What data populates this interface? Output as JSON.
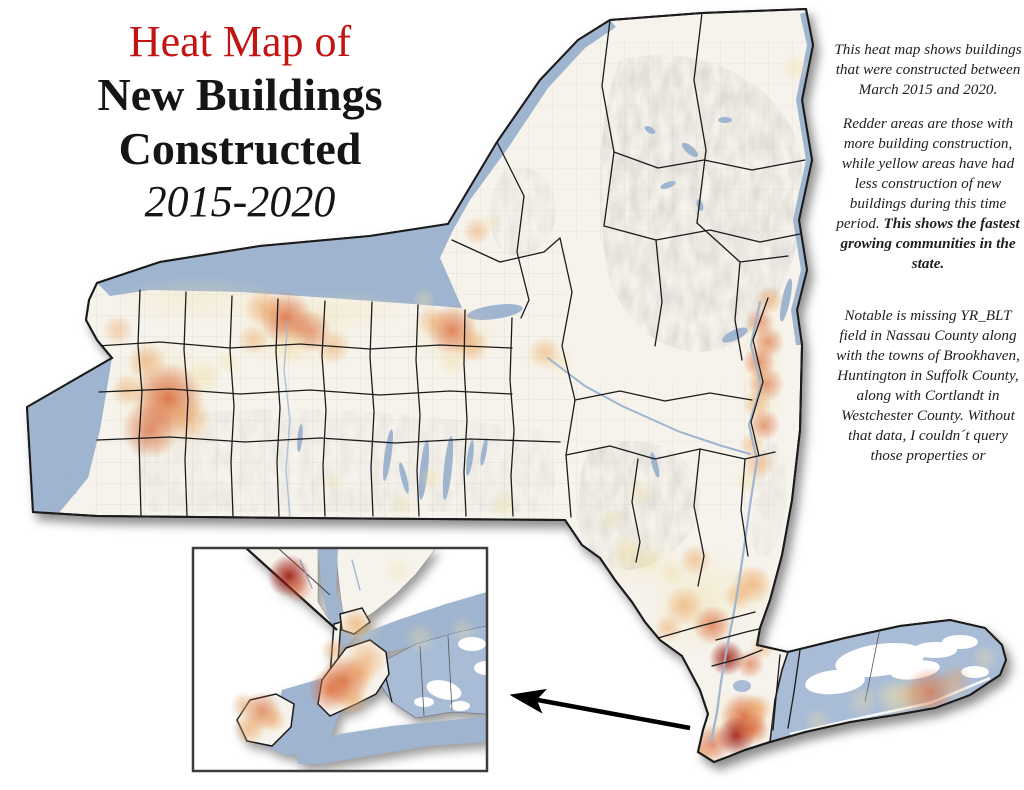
{
  "title": {
    "line1": "Heat Map of",
    "line2": "New Buildings",
    "line3": "Constructed",
    "line4": "2015-2020"
  },
  "description": {
    "para1": "This heat map shows buildings that were constructed between March 2015 and 2020.",
    "para2": "Redder areas are those with more building construction, while yellow areas have had less construction of new buildings during this time period. ",
    "para2_bold": "This shows the fastest growing communities in the state.",
    "para3": "Notable is missing YR_BLT field in Nassau County along with the towns of Brookhaven, Huntington in Suffolk County, along with Cortlandt in Westchester County. Without that data, I couldn´t query those properties or"
  },
  "map": {
    "colors": {
      "title_accent": "#c31414",
      "body_text": "#1f1f1f",
      "water": "#9fb4cf",
      "missing_data": "#a9bcd6",
      "land": "#f6f3ec",
      "county_line": "#1b1b1b",
      "town_line": "#b6b1a3",
      "arrow": "#000000"
    },
    "heat": {
      "palette": {
        "yellow": "#f0dfa6",
        "orange": "#ec9f58",
        "red": "#d95f2e",
        "dark": "#9c150a"
      },
      "main_spots": [
        [
          168,
          398,
          20,
          "red",
          0.85
        ],
        [
          150,
          430,
          16,
          "red",
          0.7
        ],
        [
          147,
          362,
          11,
          "orange",
          0.6
        ],
        [
          188,
          420,
          13,
          "orange",
          0.55
        ],
        [
          127,
          390,
          9,
          "orange",
          0.5
        ],
        [
          118,
          330,
          9,
          "orange",
          0.45
        ],
        [
          205,
          375,
          10,
          "yellow",
          0.5
        ],
        [
          286,
          318,
          15,
          "red",
          0.8
        ],
        [
          264,
          308,
          11,
          "orange",
          0.6
        ],
        [
          310,
          331,
          12,
          "red",
          0.6
        ],
        [
          333,
          347,
          10,
          "orange",
          0.5
        ],
        [
          253,
          340,
          9,
          "orange",
          0.45
        ],
        [
          290,
          346,
          10,
          "yellow",
          0.5
        ],
        [
          228,
          362,
          7,
          "yellow",
          0.45
        ],
        [
          452,
          330,
          14,
          "red",
          0.75
        ],
        [
          471,
          345,
          10,
          "orange",
          0.6
        ],
        [
          432,
          321,
          9,
          "orange",
          0.5
        ],
        [
          452,
          361,
          9,
          "yellow",
          0.5
        ],
        [
          424,
          300,
          7,
          "yellow",
          0.4
        ],
        [
          477,
          231,
          8,
          "orange",
          0.5
        ],
        [
          492,
          222,
          6,
          "yellow",
          0.4
        ],
        [
          545,
          352,
          9,
          "orange",
          0.45
        ],
        [
          561,
          363,
          8,
          "yellow",
          0.4
        ],
        [
          795,
          68,
          8,
          "yellow",
          0.45
        ],
        [
          770,
          300,
          8,
          "orange",
          0.6
        ],
        [
          760,
          322,
          8,
          "red",
          0.55
        ],
        [
          768,
          342,
          9,
          "red",
          0.6
        ],
        [
          759,
          362,
          9,
          "red",
          0.65
        ],
        [
          766,
          384,
          10,
          "red",
          0.6
        ],
        [
          757,
          404,
          8,
          "orange",
          0.55
        ],
        [
          764,
          425,
          9,
          "red",
          0.6
        ],
        [
          752,
          445,
          7,
          "orange",
          0.5
        ],
        [
          758,
          464,
          9,
          "orange",
          0.55
        ],
        [
          748,
          481,
          8,
          "yellow",
          0.5
        ],
        [
          432,
          478,
          7,
          "yellow",
          0.45
        ],
        [
          505,
          505,
          9,
          "yellow",
          0.45
        ],
        [
          402,
          505,
          7,
          "yellow",
          0.4
        ],
        [
          332,
          482,
          7,
          "yellow",
          0.35
        ],
        [
          640,
          492,
          8,
          "yellow",
          0.4
        ],
        [
          612,
          520,
          8,
          "yellow",
          0.4
        ],
        [
          628,
          552,
          9,
          "yellow",
          0.5
        ],
        [
          648,
          562,
          8,
          "yellow",
          0.45
        ],
        [
          695,
          560,
          9,
          "orange",
          0.5
        ],
        [
          672,
          572,
          8,
          "yellow",
          0.45
        ],
        [
          752,
          584,
          11,
          "orange",
          0.65
        ],
        [
          738,
          596,
          8,
          "orange",
          0.5
        ],
        [
          684,
          606,
          11,
          "orange",
          0.6
        ],
        [
          712,
          625,
          11,
          "red",
          0.7
        ],
        [
          668,
          628,
          8,
          "orange",
          0.5
        ],
        [
          727,
          658,
          10,
          "dark",
          0.9
        ],
        [
          750,
          664,
          8,
          "red",
          0.6
        ],
        [
          762,
          648,
          7,
          "orange",
          0.5
        ],
        [
          744,
          716,
          13,
          "red",
          0.85
        ],
        [
          736,
          736,
          11,
          "dark",
          0.9
        ],
        [
          753,
          729,
          9,
          "red",
          0.75
        ],
        [
          712,
          744,
          11,
          "red",
          0.7
        ],
        [
          700,
          753,
          7,
          "orange",
          0.6
        ],
        [
          758,
          708,
          8,
          "orange",
          0.6
        ],
        [
          930,
          692,
          14,
          "red",
          0.65
        ],
        [
          955,
          680,
          9,
          "orange",
          0.5
        ],
        [
          910,
          697,
          9,
          "orange",
          0.45
        ],
        [
          895,
          700,
          11,
          "yellow",
          0.5
        ],
        [
          862,
          702,
          9,
          "yellow",
          0.4
        ],
        [
          985,
          658,
          8,
          "yellow",
          0.4
        ],
        [
          818,
          722,
          8,
          "yellow",
          0.4
        ]
      ],
      "main_tints": [
        [
          165,
          400,
          55,
          65,
          0.45
        ],
        [
          295,
          330,
          65,
          40,
          0.45
        ],
        [
          455,
          335,
          50,
          30,
          0.4
        ],
        [
          762,
          370,
          22,
          85,
          0.45
        ],
        [
          700,
          600,
          55,
          55,
          0.4
        ],
        [
          740,
          720,
          40,
          30,
          0.45
        ],
        [
          920,
          692,
          55,
          18,
          0.4
        ],
        [
          545,
          357,
          25,
          18,
          0.3
        ],
        [
          640,
          560,
          40,
          30,
          0.3
        ],
        [
          750,
          590,
          30,
          25,
          0.35
        ],
        [
          200,
          300,
          90,
          25,
          0.3
        ],
        [
          350,
          310,
          60,
          20,
          0.3
        ]
      ],
      "inset_spots": [
        [
          289,
          576,
          12,
          "dark",
          0.95
        ],
        [
          299,
          589,
          8,
          "red",
          0.5
        ],
        [
          398,
          570,
          8,
          "yellow",
          0.35
        ],
        [
          356,
          624,
          9,
          "orange",
          0.6
        ],
        [
          333,
          650,
          7,
          "orange",
          0.5
        ],
        [
          366,
          660,
          12,
          "orange",
          0.6
        ],
        [
          345,
          680,
          14,
          "red",
          0.8
        ],
        [
          330,
          690,
          12,
          "red",
          0.75
        ],
        [
          352,
          700,
          9,
          "orange",
          0.55
        ],
        [
          360,
          673,
          9,
          "orange",
          0.5
        ],
        [
          262,
          711,
          11,
          "red",
          0.65
        ],
        [
          249,
          729,
          9,
          "orange",
          0.6
        ],
        [
          274,
          720,
          7,
          "orange",
          0.5
        ],
        [
          243,
          704,
          7,
          "orange",
          0.45
        ],
        [
          420,
          638,
          9,
          "yellow",
          0.4
        ],
        [
          463,
          630,
          8,
          "yellow",
          0.35
        ]
      ],
      "inset_tints": [
        [
          345,
          685,
          32,
          28,
          0.4
        ],
        [
          260,
          718,
          26,
          20,
          0.4
        ],
        [
          360,
          630,
          25,
          20,
          0.3
        ]
      ]
    }
  }
}
